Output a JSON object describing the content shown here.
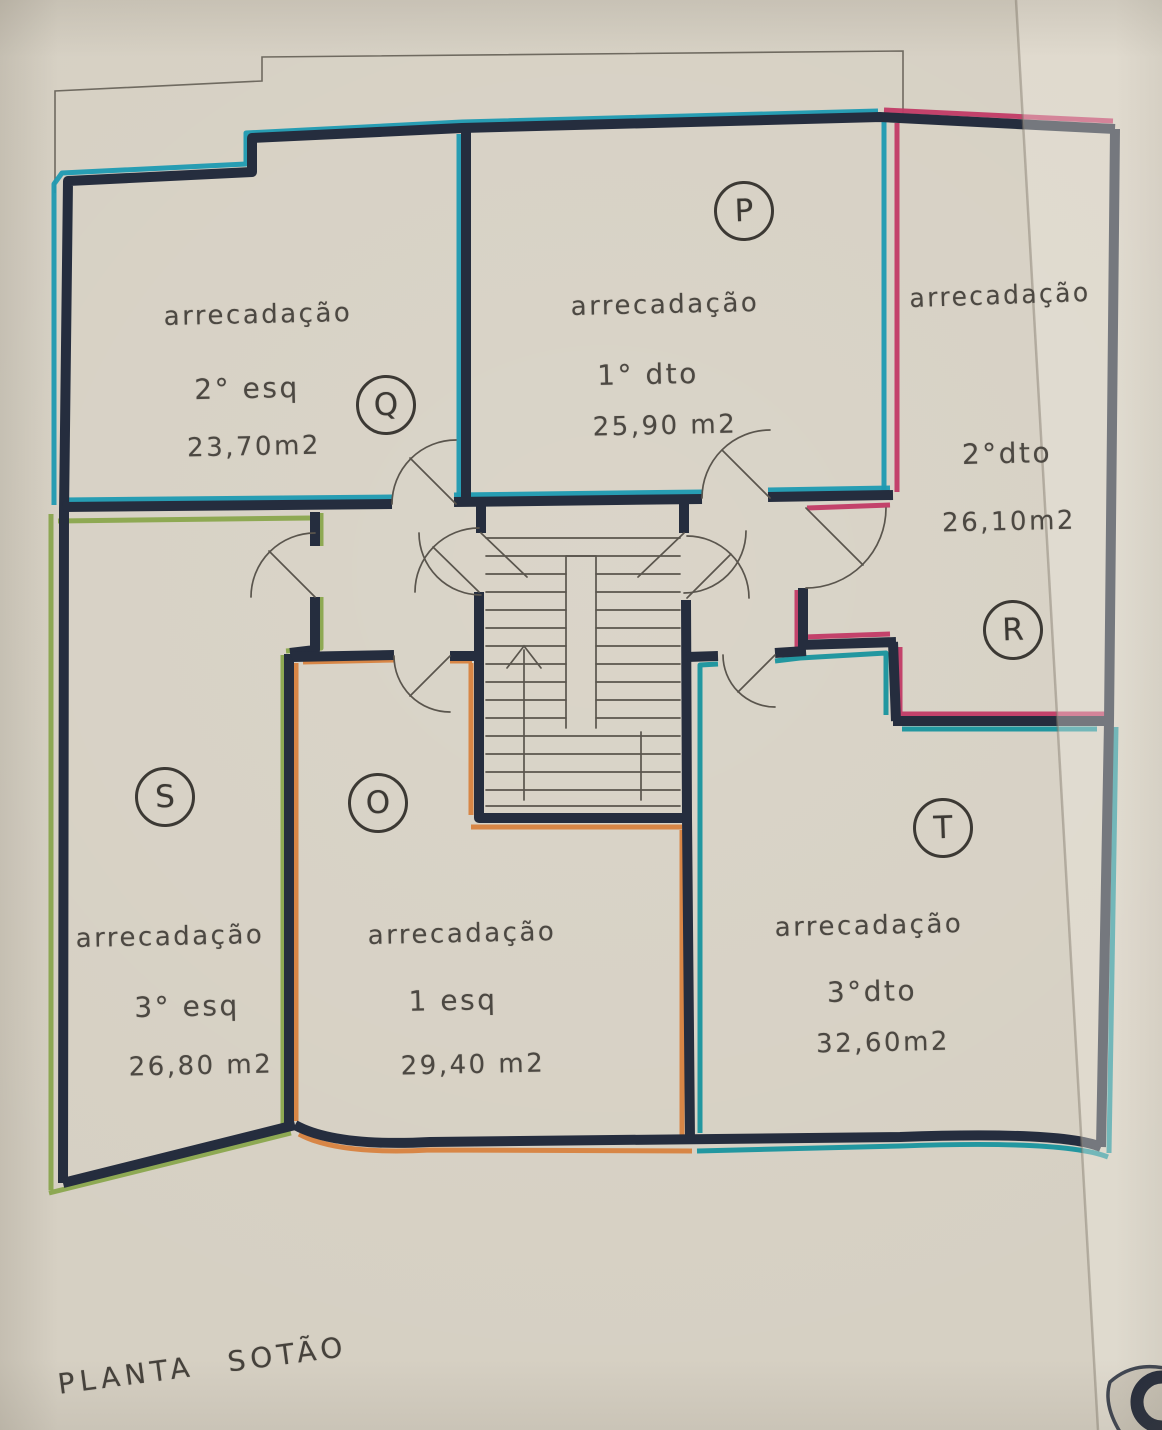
{
  "title": "PLANTA SOTÃO",
  "rooms": [
    {
      "id": "Q",
      "letter": "Q",
      "label": "arrecadação",
      "unit": "2° esq",
      "area": "23,70m2",
      "trace_color": "#1e9ab2"
    },
    {
      "id": "P",
      "letter": "P",
      "label": "arrecadação",
      "unit": "1° dto",
      "area": "25,90 m2",
      "trace_color": "#1e9ab2"
    },
    {
      "id": "R",
      "letter": "R",
      "label": "arrecadação",
      "unit": "2°dto",
      "area": "26,10m2",
      "trace_color": "#c23a66"
    },
    {
      "id": "S",
      "letter": "S",
      "label": "arrecadação",
      "unit": "3° esq",
      "area": "26,80 m2",
      "trace_color": "#8aa74d"
    },
    {
      "id": "O",
      "letter": "O",
      "label": "arrecadação",
      "unit": "1 esq",
      "area": "29,40 m2",
      "trace_color": "#d8823f"
    },
    {
      "id": "T",
      "letter": "T",
      "label": "arrecadação",
      "unit": "3°dto",
      "area": "32,60m2",
      "trace_color": "#18939e"
    }
  ],
  "colors": {
    "paper": "#d6d0c3",
    "wall-ink": "#252d3e",
    "pencil": "#5a554d",
    "text-ink": "#4c4842",
    "trace-cyan": "#1e9ab2",
    "trace-teal": "#18939e",
    "trace-green": "#8aa74d",
    "trace-orange": "#d8823f",
    "trace-pink": "#c23a66"
  }
}
